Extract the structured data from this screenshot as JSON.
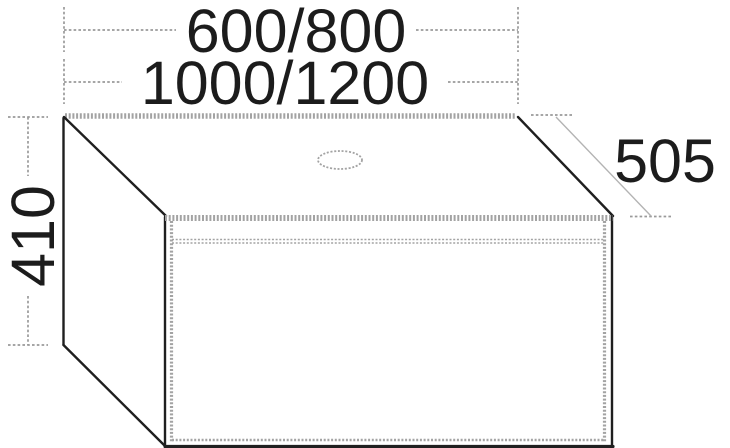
{
  "drawing": {
    "kind": "furniture-dimension-diagram",
    "dimensions": {
      "top_width_1": "600/800",
      "top_width_2": "1000/1200",
      "height_left": "410",
      "depth_right": "505"
    },
    "units": "mm",
    "colors": {
      "background": "#ffffff",
      "outline": "#1f1f1f",
      "panel_edges": "#a3a3a3",
      "dimension_lines": "#9a9a9a",
      "text": "#1c1c1c"
    }
  }
}
